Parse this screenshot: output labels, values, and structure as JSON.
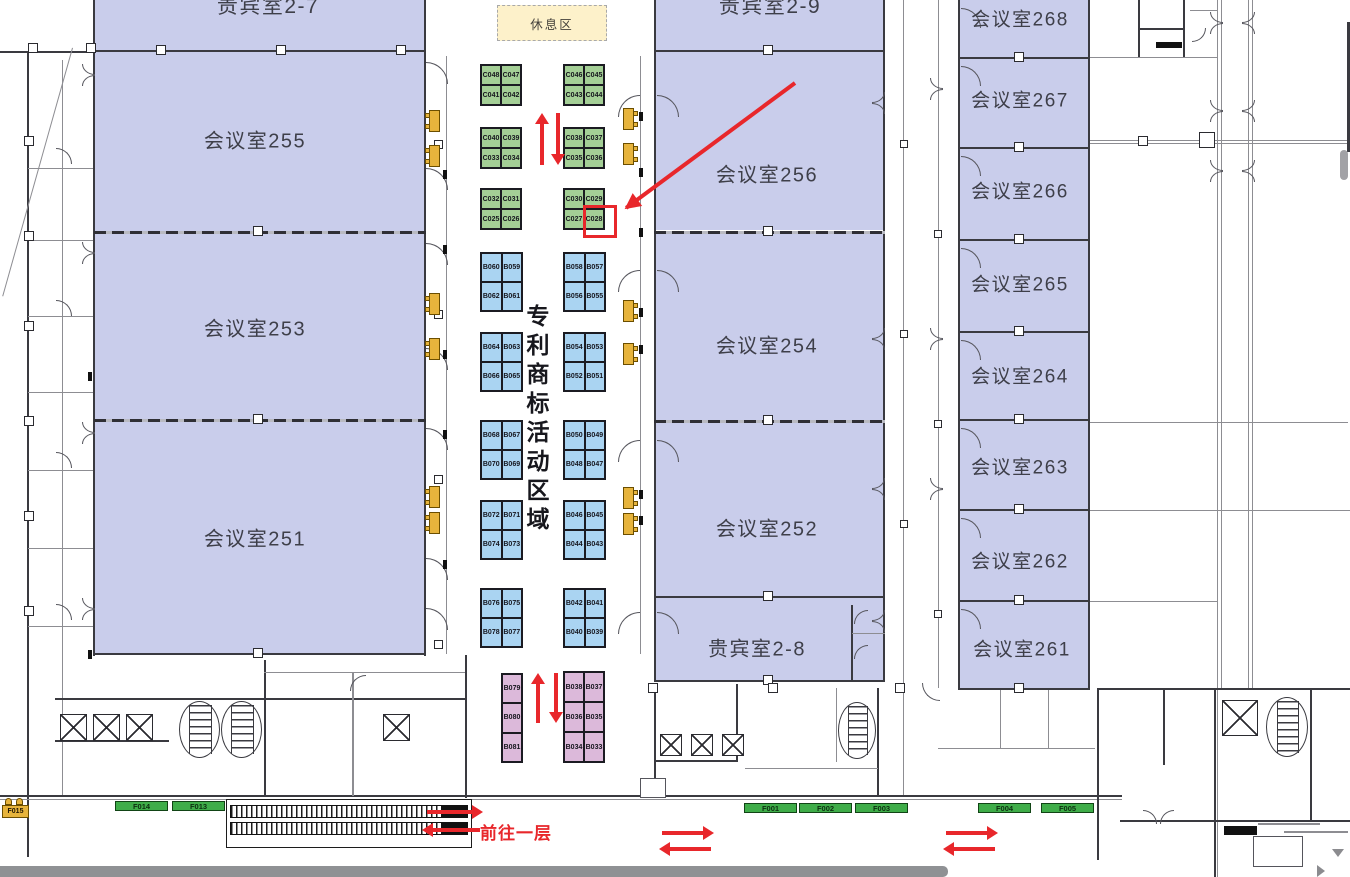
{
  "labels": {
    "rest_area": "休息区",
    "activity_zone": "专利商标活动区域",
    "go_first_floor": "前往一层"
  },
  "colors": {
    "room_fill": "#c9cdeb",
    "green_booth": "#a4cf96",
    "blue_booth": "#aad4f2",
    "pink_booth": "#dcb9da",
    "rest_fill": "#fdf1ca",
    "red_accent": "#e8272b",
    "floor_marker_green": "#3fad49",
    "wall_tag_yellow": "#e7b43c",
    "scrollbar_gray": "#8f9194"
  },
  "rooms": [
    {
      "id": "vip-2-7",
      "label": "贵宾室2-7",
      "x": 95,
      "y": 0,
      "w": 330,
      "h": 50,
      "lx": 268,
      "ly": 5,
      "fs": 21
    },
    {
      "id": "meeting-255",
      "label": "会议室255",
      "x": 95,
      "y": 52,
      "w": 330,
      "h": 179,
      "lx": 255,
      "ly": 139,
      "fs": 20
    },
    {
      "id": "meeting-253",
      "label": "会议室253",
      "x": 95,
      "y": 233,
      "w": 330,
      "h": 186,
      "lx": 255,
      "ly": 327,
      "fs": 20
    },
    {
      "id": "meeting-251",
      "label": "会议室251",
      "x": 95,
      "y": 421,
      "w": 330,
      "h": 233,
      "lx": 255,
      "ly": 537,
      "fs": 20
    },
    {
      "id": "vip-2-9",
      "label": "贵宾室2-9",
      "x": 655,
      "y": 0,
      "w": 229,
      "h": 50,
      "lx": 770,
      "ly": 5,
      "fs": 21
    },
    {
      "id": "meeting-256",
      "label": "会议室256",
      "x": 655,
      "y": 52,
      "w": 229,
      "h": 178,
      "lx": 767,
      "ly": 173,
      "fs": 20
    },
    {
      "id": "meeting-254",
      "label": "会议室254",
      "x": 655,
      "y": 232,
      "w": 229,
      "h": 188,
      "lx": 767,
      "ly": 344,
      "fs": 20
    },
    {
      "id": "meeting-252",
      "label": "会议室252",
      "x": 655,
      "y": 422,
      "w": 229,
      "h": 174,
      "lx": 767,
      "ly": 527,
      "fs": 20
    },
    {
      "id": "vip-2-8",
      "label": "贵宾室2-8",
      "x": 655,
      "y": 598,
      "w": 229,
      "h": 82,
      "lx": 757,
      "ly": 647,
      "fs": 20
    },
    {
      "id": "meeting-268",
      "label": "会议室268",
      "x": 960,
      "y": 0,
      "w": 128,
      "h": 57,
      "lx": 1020,
      "ly": 18,
      "fs": 19
    },
    {
      "id": "meeting-267",
      "label": "会议室267",
      "x": 960,
      "y": 59,
      "w": 128,
      "h": 88,
      "lx": 1020,
      "ly": 99,
      "fs": 19
    },
    {
      "id": "meeting-266",
      "label": "会议室266",
      "x": 960,
      "y": 149,
      "w": 128,
      "h": 90,
      "lx": 1020,
      "ly": 190,
      "fs": 19
    },
    {
      "id": "meeting-265",
      "label": "会议室265",
      "x": 960,
      "y": 241,
      "w": 128,
      "h": 90,
      "lx": 1020,
      "ly": 283,
      "fs": 19
    },
    {
      "id": "meeting-264",
      "label": "会议室264",
      "x": 960,
      "y": 333,
      "w": 128,
      "h": 86,
      "lx": 1020,
      "ly": 375,
      "fs": 19
    },
    {
      "id": "meeting-263",
      "label": "会议室263",
      "x": 960,
      "y": 421,
      "w": 128,
      "h": 88,
      "lx": 1020,
      "ly": 466,
      "fs": 19
    },
    {
      "id": "meeting-262",
      "label": "会议室262",
      "x": 960,
      "y": 511,
      "w": 128,
      "h": 89,
      "lx": 1020,
      "ly": 560,
      "fs": 19
    },
    {
      "id": "meeting-261",
      "label": "会议室261",
      "x": 960,
      "y": 602,
      "w": 128,
      "h": 86,
      "lx": 1022,
      "ly": 648,
      "fs": 19
    }
  ],
  "green_blocks": [
    {
      "x": 480,
      "y": 64,
      "cells": [
        [
          "C048",
          "C047"
        ],
        [
          "C041",
          "C042"
        ]
      ]
    },
    {
      "x": 563,
      "y": 64,
      "cells": [
        [
          "C046",
          "C045"
        ],
        [
          "C043",
          "C044"
        ]
      ]
    },
    {
      "x": 480,
      "y": 127,
      "cells": [
        [
          "C040",
          "C039"
        ],
        [
          "C033",
          "C034"
        ]
      ]
    },
    {
      "x": 563,
      "y": 127,
      "cells": [
        [
          "C038",
          "C037"
        ],
        [
          "C035",
          "C036"
        ]
      ]
    },
    {
      "x": 480,
      "y": 188,
      "cells": [
        [
          "C032",
          "C031"
        ],
        [
          "C025",
          "C026"
        ]
      ]
    },
    {
      "x": 563,
      "y": 188,
      "cells": [
        [
          "C030",
          "C029"
        ],
        [
          "C027",
          "C028"
        ]
      ]
    }
  ],
  "blue_blocks": [
    {
      "x": 480,
      "y": 252,
      "cells": [
        [
          "B060",
          "B059"
        ],
        [
          "B062",
          "B061"
        ]
      ]
    },
    {
      "x": 563,
      "y": 252,
      "cells": [
        [
          "B058",
          "B057"
        ],
        [
          "B056",
          "B055"
        ]
      ]
    },
    {
      "x": 480,
      "y": 332,
      "cells": [
        [
          "B064",
          "B063"
        ],
        [
          "B066",
          "B065"
        ]
      ]
    },
    {
      "x": 563,
      "y": 332,
      "cells": [
        [
          "B054",
          "B053"
        ],
        [
          "B052",
          "B051"
        ]
      ]
    },
    {
      "x": 480,
      "y": 420,
      "cells": [
        [
          "B068",
          "B067"
        ],
        [
          "B070",
          "B069"
        ]
      ]
    },
    {
      "x": 563,
      "y": 420,
      "cells": [
        [
          "B050",
          "B049"
        ],
        [
          "B048",
          "B047"
        ]
      ]
    },
    {
      "x": 480,
      "y": 500,
      "cells": [
        [
          "B072",
          "B071"
        ],
        [
          "B074",
          "B073"
        ]
      ]
    },
    {
      "x": 563,
      "y": 500,
      "cells": [
        [
          "B046",
          "B045"
        ],
        [
          "B044",
          "B043"
        ]
      ]
    },
    {
      "x": 480,
      "y": 588,
      "cells": [
        [
          "B076",
          "B075"
        ],
        [
          "B078",
          "B077"
        ]
      ]
    },
    {
      "x": 563,
      "y": 588,
      "cells": [
        [
          "B042",
          "B041"
        ],
        [
          "B040",
          "B039"
        ]
      ]
    }
  ],
  "pink_blocks": {
    "left_column": {
      "x": 501,
      "y": 673,
      "w": 22,
      "cell_h": 30,
      "cells": [
        "B079",
        "B080",
        "B081"
      ]
    },
    "right_block": {
      "x": 563,
      "y": 671,
      "w": 42,
      "h": 92,
      "cells": [
        [
          "B038",
          "B037"
        ],
        [
          "B036",
          "B035"
        ],
        [
          "B034",
          "B033"
        ]
      ]
    }
  },
  "floor_markers": [
    {
      "label": "F014",
      "x": 115,
      "y": 801
    },
    {
      "label": "F013",
      "x": 172,
      "y": 801
    },
    {
      "label": "F001",
      "x": 744,
      "y": 803
    },
    {
      "label": "F002",
      "x": 799,
      "y": 803
    },
    {
      "label": "F003",
      "x": 855,
      "y": 803
    },
    {
      "label": "F004",
      "x": 978,
      "y": 803
    },
    {
      "label": "F005",
      "x": 1041,
      "y": 803
    }
  ],
  "corner_tag": {
    "label": "F015"
  },
  "highlight": {
    "target_booth": "C028",
    "x": 583,
    "y": 205,
    "w": 34,
    "h": 33
  }
}
